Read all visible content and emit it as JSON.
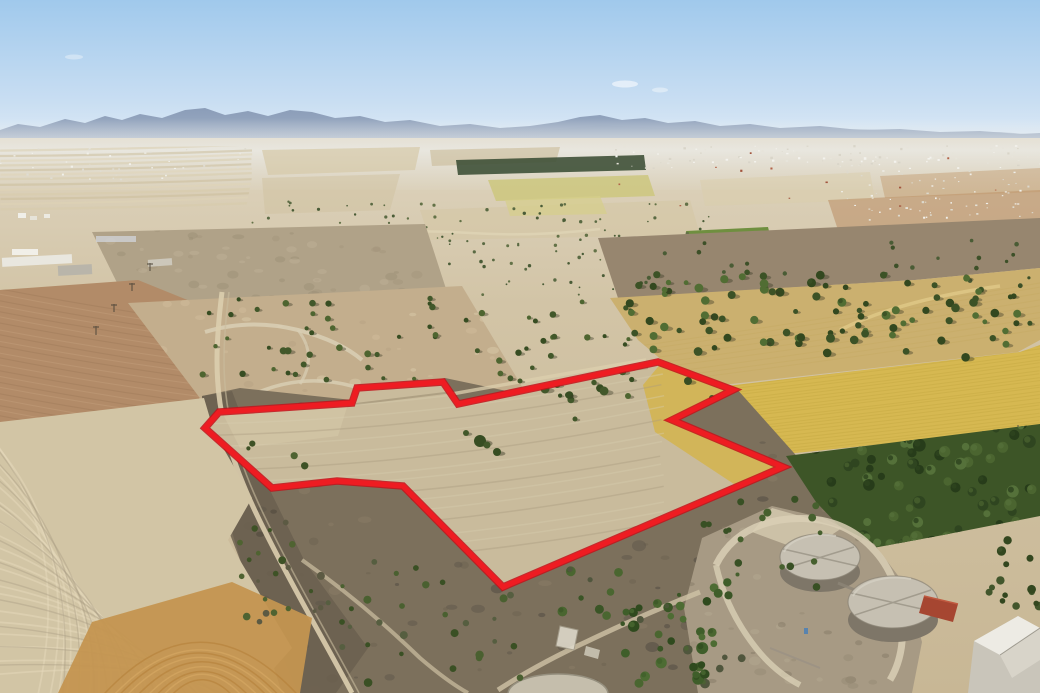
{
  "meta": {
    "description": "Aerial drone photograph of dry Cypriot farmland with a land parcel outlined in red, olive groves, a golden wheat field, scrubland and two cylindrical water tanks near the bottom right, hazy mountains on the horizon under a clear blue sky",
    "width": 1040,
    "height": 693
  },
  "parcel": {
    "points": "205,428 219,412 352,403 357,388 443,382 458,404 658,362 733,390 672,420 783,467 503,587 403,486 337,481 272,488",
    "stroke_width_outer": 7.5,
    "stroke_width_inner": 5.2
  },
  "palette": {
    "sky_top": "#a0c9ec",
    "sky_mid": "#c9def2",
    "sky_low": "#e9f1f8",
    "mtn": "#8799b5",
    "mtn_far": "#aab9cc",
    "base1": "#ded4bf",
    "base2": "#d2c4a6",
    "base3": "#c8b795",
    "gray_field": "#b0a288",
    "pink_field": "#b28b68",
    "sandy": "#c3ae8d",
    "brown_band": "#97866f",
    "gold_band": "#cbb06f",
    "wheat": "#d6b851",
    "orchard": "#3d5527",
    "scrub": "#7c705c",
    "strip": "#6b6150",
    "stubble": "#d2c5a5",
    "orange": "#c49550",
    "parcel_fill": "#c9bb9c",
    "parcel_light": "#d5c8a8",
    "wheat_in": "#d3b455",
    "compound": "#a79a84",
    "path": "#d9cfb5",
    "track": "#dbceae",
    "tank_top": "#c6c0b2",
    "tank_side": "#7e7668",
    "tank_seam": "#a29c8e",
    "tank_rim": "#8a8375",
    "shed": "#a64631",
    "wall": "#c9c5ba",
    "roof_light": "#edebe4",
    "roof_mid": "#d8d4c9",
    "pad": "#c5beac",
    "red": "#ee1c22",
    "red_dark": "#c3121a",
    "cypress": "#3f5138",
    "green_patch": "#6f8f3f",
    "yellow_patch": "#cdc77e",
    "yellow_patch2": "#d5cf8a",
    "orange_far": "#b98d62",
    "light_far": "#d9cdab"
  },
  "scene": {
    "scatters": [
      {
        "g": "sc-distant1",
        "name": "olive-tree-distant",
        "x": 248,
        "y": 200,
        "w": 465,
        "h": 96,
        "n": 140,
        "r": [
          0.8,
          1.8
        ],
        "colors": [
          "#5a6a43",
          "#4a5c37",
          "#637247"
        ],
        "shadow": false
      },
      {
        "g": "sc-distant2",
        "name": "olive-tree-distant",
        "x": 612,
        "y": 230,
        "w": 428,
        "h": 66,
        "n": 70,
        "r": [
          1,
          2
        ],
        "colors": [
          "#55663f",
          "#475a35"
        ],
        "shadow": false
      },
      {
        "g": "sc-mid",
        "name": "olive-tree",
        "x": 200,
        "y": 296,
        "w": 450,
        "h": 86,
        "n": 60,
        "r": [
          2,
          3.6
        ],
        "colors": [
          "#42582a",
          "#374d22",
          "#4e6530"
        ],
        "shadow": true
      },
      {
        "g": "sc-gold",
        "name": "olive-tree",
        "x": 625,
        "y": 272,
        "w": 413,
        "h": 86,
        "n": 95,
        "r": [
          2.4,
          4.6
        ],
        "colors": [
          "#3c5226",
          "#516d33",
          "#33481f"
        ],
        "shadow": true
      },
      {
        "g": "sc-brown",
        "name": "olive-tree",
        "x": 620,
        "y": 240,
        "w": 420,
        "h": 50,
        "n": 26,
        "r": [
          1.4,
          2.4
        ],
        "colors": [
          "#4a5c35",
          "#3d5028"
        ],
        "shadow": false
      },
      {
        "g": "sc-orchard",
        "name": "orchard-tree",
        "x": 786,
        "y": 424,
        "w": 254,
        "h": 124,
        "n": 90,
        "r": [
          3.5,
          6.5
        ],
        "colors": [
          "#2f4520",
          "#4b6530",
          "#55713a",
          "#273c1a"
        ],
        "shadow": false
      },
      {
        "g": "sc-bush1",
        "name": "scrub-bush",
        "x": 238,
        "y": 430,
        "w": 85,
        "h": 200,
        "n": 26,
        "r": [
          1.8,
          4
        ],
        "colors": [
          "#4f6331",
          "#3e5226",
          "#5c5a43"
        ],
        "shadow": false
      },
      {
        "g": "sc-bush2",
        "name": "scrub-bush",
        "x": 320,
        "y": 558,
        "w": 215,
        "h": 125,
        "n": 30,
        "r": [
          2,
          4.5
        ],
        "colors": [
          "#4a6030",
          "#3a5024",
          "#565e40"
        ],
        "shadow": false
      },
      {
        "g": "sc-bush3",
        "name": "scrub-bush",
        "x": 540,
        "y": 568,
        "w": 205,
        "h": 118,
        "n": 28,
        "r": [
          2,
          5
        ],
        "colors": [
          "#4a6630",
          "#3a5526",
          "#50563d"
        ],
        "shadow": false
      },
      {
        "g": "sc-bush4",
        "name": "scrub-bush",
        "x": 698,
        "y": 498,
        "w": 125,
        "h": 92,
        "n": 18,
        "r": [
          2,
          4
        ],
        "colors": [
          "#46602e",
          "#385024"
        ],
        "shadow": false
      },
      {
        "g": "sc-bush5",
        "name": "green-tree-cluster",
        "x": 618,
        "y": 578,
        "w": 115,
        "h": 105,
        "n": 24,
        "r": [
          3,
          6
        ],
        "colors": [
          "#3f5e2a",
          "#2f4a1e",
          "#4d6c33"
        ],
        "shadow": false
      },
      {
        "g": "sc-bush6",
        "name": "scrub-bush",
        "x": 988,
        "y": 540,
        "w": 52,
        "h": 85,
        "n": 16,
        "r": [
          2.5,
          5
        ],
        "colors": [
          "#42562c",
          "#33471f"
        ],
        "shadow": false
      },
      {
        "g": "sc-parceltop",
        "name": "olive-tree",
        "x": 520,
        "y": 370,
        "w": 150,
        "h": 38,
        "n": 8,
        "r": [
          2,
          4
        ],
        "colors": [
          "#42582a",
          "#374d22"
        ],
        "shadow": true
      }
    ],
    "specks": [
      {
        "g": "sp-town1",
        "name": "town-building",
        "x": 598,
        "y": 145,
        "w": 442,
        "h": 23,
        "n": 110,
        "s": [
          1,
          2.6
        ],
        "colors": [
          "#f3f2ed",
          "#e7e4da",
          "#d9d5c9"
        ]
      },
      {
        "g": "sp-town2",
        "name": "town-building",
        "x": 840,
        "y": 168,
        "w": 200,
        "h": 50,
        "n": 55,
        "s": [
          1,
          2.4
        ],
        "colors": [
          "#efeee8",
          "#ddd9cd"
        ]
      },
      {
        "g": "sp-town3",
        "name": "town-building",
        "x": 0,
        "y": 147,
        "w": 245,
        "h": 32,
        "n": 42,
        "s": [
          1,
          2.4
        ],
        "colors": [
          "#f1f0ea",
          "#dfdcd2"
        ]
      },
      {
        "g": "sp-roofs",
        "name": "town-roof",
        "x": 610,
        "y": 150,
        "w": 420,
        "h": 58,
        "n": 12,
        "s": [
          1.4,
          2.4
        ],
        "colors": [
          "#b26248",
          "#a2543d"
        ]
      },
      {
        "g": "sp-town4",
        "name": "village-building",
        "x": 858,
        "y": 204,
        "w": 182,
        "h": 24,
        "n": 18,
        "s": [
          1.2,
          2.6
        ],
        "colors": [
          "#f2f1eb",
          "#e4e1d6"
        ]
      }
    ],
    "mottles": [
      {
        "g": "mo-gray",
        "name": "soil-mottle",
        "x": 92,
        "y": 226,
        "w": 356,
        "h": 78,
        "n": 60,
        "r": [
          2,
          6
        ],
        "colors": [
          "#a2947a",
          "#c2b49a",
          "#998c72"
        ],
        "op": 0.4
      },
      {
        "g": "mo-sandy",
        "name": "ground-mottle",
        "x": 140,
        "y": 300,
        "w": 380,
        "h": 110,
        "n": 45,
        "r": [
          2,
          6
        ],
        "colors": [
          "#d2bf9d",
          "#b5a283",
          "#dccfae"
        ],
        "op": 0.45
      },
      {
        "g": "mo-scrub",
        "name": "scrub-mottle",
        "x": 230,
        "y": 400,
        "w": 640,
        "h": 290,
        "n": 130,
        "r": [
          2,
          7
        ],
        "colors": [
          "#5d554a",
          "#6b6150",
          "#897c65",
          "#4e483f"
        ],
        "op": 0.5
      },
      {
        "g": "mo-strip",
        "name": "scrub-mottle",
        "x": 205,
        "y": 395,
        "w": 160,
        "h": 295,
        "n": 48,
        "r": [
          2,
          6
        ],
        "colors": [
          "#4e473d",
          "#5f574a",
          "#6d6454"
        ],
        "op": 0.55
      },
      {
        "g": "mo-compound",
        "name": "ground-mottle",
        "x": 690,
        "y": 510,
        "w": 230,
        "h": 180,
        "n": 55,
        "r": [
          2,
          6
        ],
        "colors": [
          "#968a74",
          "#b3a78f",
          "#857a66"
        ],
        "op": 0.5
      }
    ],
    "curves": [
      {
        "g": "cv-leftstripes",
        "name": "field-stripe",
        "n": 13,
        "p1": [
          0,
          151
        ],
        "p1s": [
          0,
          4.8
        ],
        "p2": [
          252,
          145
        ],
        "p2s": [
          0,
          4.8
        ],
        "bow": [
          0,
          2
        ],
        "bows": [
          0,
          0
        ],
        "colors": [
          "#d8cbaa",
          "#c9bb97",
          "#e0d4b6"
        ],
        "w": 2.2,
        "op": 0.5,
        "jit": 1.5
      },
      {
        "g": "cv-pink",
        "name": "furrow-line",
        "n": 24,
        "p1": [
          -5,
          288
        ],
        "p1s": [
          0,
          5.8
        ],
        "p2": [
          235,
          326
        ],
        "p2s": [
          0,
          5.8
        ],
        "bow": [
          0,
          4
        ],
        "bows": [
          0,
          0
        ],
        "colors": [
          "#9d7a59",
          "#c3a07c"
        ],
        "w": 1.1,
        "op": 0.45,
        "jit": 2
      },
      {
        "g": "cv-stubLight",
        "name": "furrow-line",
        "n": 20,
        "p1": [
          -20,
          418
        ],
        "p1s": [
          0,
          13.5
        ],
        "p2": [
          36,
          700
        ],
        "p2s": [
          10.5,
          0
        ],
        "bow": [
          70,
          -30
        ],
        "bows": [
          0,
          0
        ],
        "colors": [
          "#e6dabb"
        ],
        "w": 1.8,
        "op": 0.5,
        "jit": 6
      },
      {
        "g": "cv-stubDark",
        "name": "furrow-line",
        "n": 12,
        "p1": [
          -20,
          424
        ],
        "p1s": [
          0,
          22
        ],
        "p2": [
          60,
          700
        ],
        "p2s": [
          16,
          0
        ],
        "bow": [
          60,
          -26
        ],
        "bows": [
          0,
          0
        ],
        "colors": [
          "#a89b82"
        ],
        "w": 1.4,
        "op": 0.4,
        "jit": 8
      },
      {
        "g": "cv-orange",
        "name": "furrow-line",
        "n": 9,
        "p1": [
          100,
          698
        ],
        "p1s": [
          9,
          0
        ],
        "p2": [
          300,
          698
        ],
        "p2s": [
          -8,
          0
        ],
        "bow": [
          0,
          -108
        ],
        "bows": [
          0,
          9
        ],
        "colors": [
          "#b27c33",
          "#dcae67"
        ],
        "w": 1.5,
        "op": 0.5,
        "jit": 4
      },
      {
        "g": "cv-parcel",
        "name": "furrow-line",
        "n": 15,
        "p1": [
          212,
          414
        ],
        "p1s": [
          0,
          11
        ],
        "p2": [
          662,
          362
        ],
        "p2s": [
          0,
          11.5
        ],
        "bow": [
          0,
          20
        ],
        "bows": [
          0,
          0
        ],
        "colors": [
          "#d8ccae",
          "#d8ccae",
          "#a99c7f"
        ],
        "w": 1.5,
        "op": 0.4,
        "jit": 5
      },
      {
        "g": "cv-wheat",
        "name": "crop-row-line",
        "n": 24,
        "p1": [
          690,
          391
        ],
        "p1s": [
          0,
          3.2
        ],
        "p2": [
          1040,
          346
        ],
        "p2s": [
          0,
          3.5
        ],
        "bow": [
          0,
          2
        ],
        "bows": [
          0,
          0
        ],
        "colors": [
          "#bfa23c"
        ],
        "w": 1,
        "op": 0.32,
        "jit": 1.5
      },
      {
        "g": "cv-gold",
        "name": "crop-row-line",
        "n": 9,
        "p1": [
          640,
          345
        ],
        "p1s": [
          0,
          5
        ],
        "p2": [
          1040,
          282
        ],
        "p2s": [
          0,
          6
        ],
        "bow": [
          0,
          3
        ],
        "bows": [
          0,
          0
        ],
        "colors": [
          "#c2a45e"
        ],
        "w": 1,
        "op": 0.3,
        "jit": 2
      }
    ]
  }
}
